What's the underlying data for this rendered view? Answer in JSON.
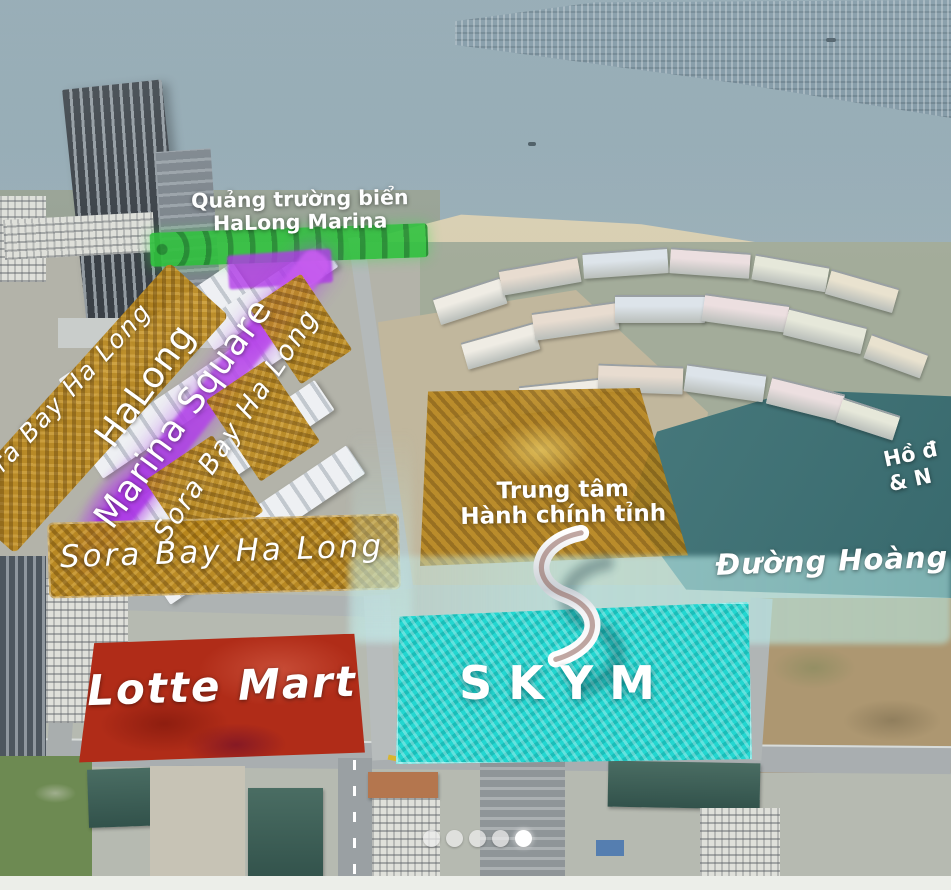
{
  "meta": {
    "description": "Aerial master-plan marketing map of HaLong Marina area with highlighted land parcels"
  },
  "labels": {
    "beach_square_line1": "Quảng trường biển",
    "beach_square_line2": "HaLong Marina",
    "marina_square_line1": "HaLong",
    "marina_square_line2": "Marina Square",
    "sora_left": "Sora Bay Ha Long",
    "sora_diagonal": "Sora Bay Ha Long",
    "sora_horizontal": "Sora Bay Ha Long",
    "admin_line1": "Trung tâm",
    "admin_line2": "Hành chính tỉnh",
    "road": "Đường Hoàng",
    "lake_line1": "Hồ đ",
    "lake_line2": "& N",
    "lotte": "Lotte Mart",
    "skym": "SKYM"
  },
  "colors": {
    "highlight_green": "#2ec23c",
    "highlight_purple": "#b13ae8",
    "highlight_gold": "#b9871c",
    "highlight_red": "#b02c18",
    "highlight_cyan": "#23d6d0",
    "road_glow": "#bfe9e7",
    "lake": "#3f7174",
    "sea": "#93a9b3"
  },
  "carousel": {
    "count": 5,
    "active_index": 4
  }
}
